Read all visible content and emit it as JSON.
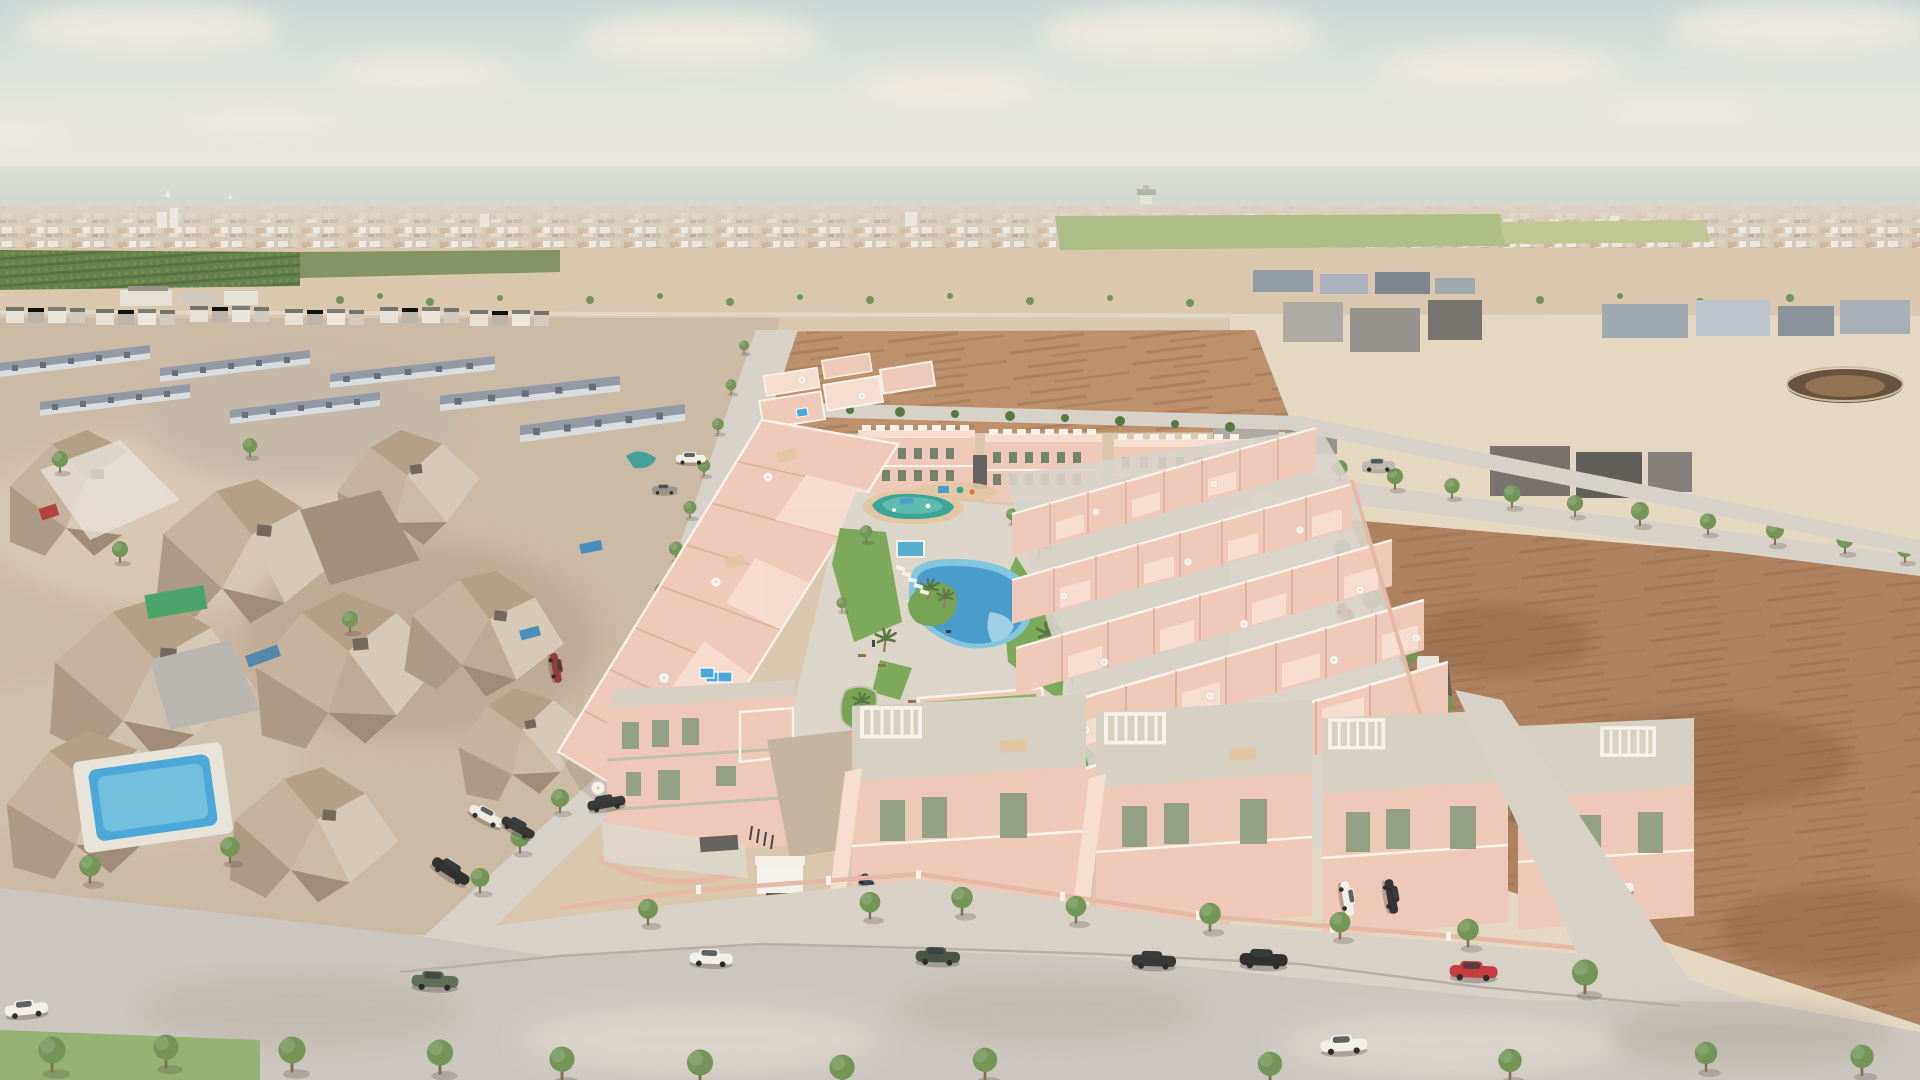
{
  "meta": {
    "kind": "aerial-3d-render",
    "subject": "seaside residential development of pink townhouses with communal lagoon pool, surrounded by existing photogrammetry neighborhood, empty dirt lots and distant coastal town"
  },
  "palette": {
    "sky_top": "#c7d4d3",
    "sky_mid": "#e2e4de",
    "sky_low": "#eceae2",
    "cloud": "#f1ece3",
    "sea": "#9fbab4",
    "sea_light": "#bcccc4",
    "town": "#cdbfae",
    "town_white": "#ece7dd",
    "town_terra": "#c09679",
    "orchard": "#5d7a41",
    "orchard_dark": "#4c6835",
    "field_light": "#a9b87f",
    "sand": "#d8c5ac",
    "sand_light": "#e5d7c0",
    "dirt": "#b98a63",
    "dirt_red": "#a97a55",
    "dirt_deep": "#8a5f3e",
    "road": "#d6d0c8",
    "road_fore": "#c9c4be",
    "sidewalk": "#d5cfc6",
    "curb": "#b3aca3",
    "plaza": "#c2b09b",
    "cobble": "#dcd6cd",
    "mesh": "#c9b6a1",
    "mesh_light": "#ddd0bf",
    "mesh_dark": "#a28d77",
    "mesh_grey": "#a8a5a0",
    "mesh_white": "#e5e0d7",
    "slate": "#8b94a2",
    "slate_light": "#d9dce0",
    "slate_dark": "#5f6672",
    "dev_pink": "#eec6b6",
    "dev_pink_light": "#f6dccf",
    "dev_pink_dark": "#d9a793",
    "dev_pink_wall": "#e5b4a3",
    "parapet": "#f8f3ea",
    "slab": "#d4cec0",
    "slab_green": "#b9bfa6",
    "window_sage": "#8d9a7e",
    "window_dark": "#6d7a62",
    "lawn": "#76a450",
    "lawn_bright": "#7fb254",
    "planter": "#6f9e48",
    "tree": "#6b8f4c",
    "tree_dark": "#55713b",
    "tree_light": "#86a75e",
    "palm": "#4d6e35",
    "pool": "#3e96c9",
    "pool_light": "#7ac2dc",
    "pool_pale": "#a7d8e8",
    "pool_teal": "#2fa093",
    "pool_teal_light": "#54b8a8",
    "pool_small": "#4aa8cf",
    "pool_bright": "#3fa3d8",
    "deck": "#e0c49e",
    "white": "#f4f1ea",
    "dark_struct": "#5c5954",
    "steel": "#9aa3ad",
    "ring": "#5c4733",
    "ring_light": "#8a6a4c",
    "shed_green": "#3f9e63",
    "tarp_teal": "#3a9a90",
    "shadow": "rgba(70,55,45,0.28)"
  },
  "vehicles": {
    "street_cars": [
      {
        "name": "white-sedan-driving-left",
        "color": "#f2f0ea"
      },
      {
        "name": "green-suv-parked",
        "color": "#57664f"
      },
      {
        "name": "white-suv-driving",
        "color": "#f2f0ea"
      },
      {
        "name": "olive-suv-parked",
        "color": "#3f4a3c"
      },
      {
        "name": "black-suv-parked-1",
        "color": "#2b2a2c"
      },
      {
        "name": "black-suv-parked-2",
        "color": "#2b2a2c"
      },
      {
        "name": "red-hatchback-parked",
        "color": "#c23030"
      },
      {
        "name": "white-sedan-driving-right",
        "color": "#f2f0ea"
      },
      {
        "name": "white-pickup-parked",
        "color": "#efece5"
      },
      {
        "name": "black-sedan-parked",
        "color": "#2b2a2c"
      },
      {
        "name": "red-van-parked",
        "color": "#8e2f2a"
      },
      {
        "name": "red-car-east-edge",
        "color": "#c23030"
      },
      {
        "name": "dark-blue-sedan-courtyard",
        "color": "#2e3a52"
      }
    ],
    "boats": [
      {
        "name": "cargo-ship",
        "color": "#5a5f52"
      },
      {
        "name": "sailboat",
        "color": "#f4f1ea"
      }
    ]
  },
  "amenities": [
    "lagoon-pool",
    "kids-splash-pool",
    "plunge-pool",
    "rooftop-pools",
    "sun-loungers",
    "palm-garden",
    "planter-islands",
    "clubhouse-roof-lawn",
    "white-plane-sculpture",
    "playground"
  ]
}
